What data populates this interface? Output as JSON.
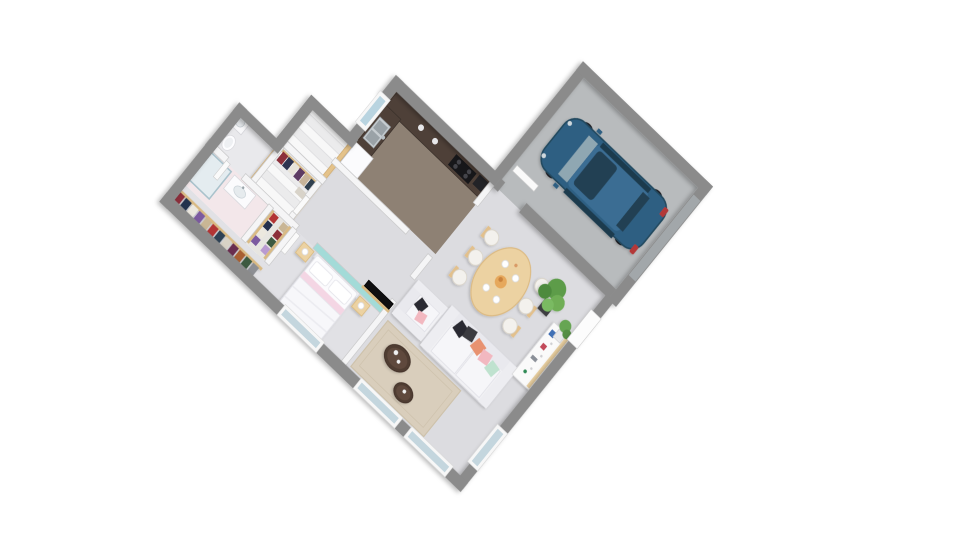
{
  "scene": {
    "description": "3D isometric top-down render of a single-storey house floor plan with attached garage",
    "view": "isometric",
    "background": "#ffffff"
  },
  "palette": {
    "exterior_wall": "#8b8b8b",
    "interior_wall": "#f5f5f6",
    "living_floor": "#dcdce0",
    "kitchen_floor": "#8e8174",
    "garage_floor": "#b8bbbd",
    "bathroom_floor": "#f3e7ea",
    "accent_teal_wall": "#a3dbd8",
    "wood_light": "#ecd2a2",
    "wood_rail": "#e4c28a",
    "countertop_dark": "#4e4038",
    "car_blue": "#2e5f82",
    "rug_beige": "#d9cebc",
    "pillow_coral": "#e8926f",
    "pillow_pink": "#f2b8c0",
    "pillow_mint": "#bfe2cf",
    "pillow_black": "#2c2c30"
  },
  "rooms": [
    {
      "name": "garage",
      "furniture": [
        "blue minivan car",
        "service door to house"
      ]
    },
    {
      "name": "kitchen",
      "furniture": [
        "L-shaped counter",
        "sink",
        "cooktop",
        "oven",
        "coffee machine",
        "fridge",
        "window above counter"
      ]
    },
    {
      "name": "dining-area",
      "furniture": [
        "oval wood table",
        "6 chairs",
        "plates",
        "bread basket"
      ]
    },
    {
      "name": "living-room",
      "furniture": [
        "white sofa with pillows",
        "armchair",
        "beige rug",
        "2 round coffee tables",
        "TV panel",
        "sideboard",
        "2 green plants",
        "2 south windows",
        "east window",
        "front door"
      ]
    },
    {
      "name": "staircase",
      "furniture": [
        "white steps",
        "wood balustrade",
        "black newel cap"
      ]
    },
    {
      "name": "wc-laundry",
      "furniture": [
        "washing machine",
        "toilet"
      ]
    },
    {
      "name": "walk-in-closet",
      "furniture": [
        "clothes rail with hanging clothes"
      ]
    },
    {
      "name": "dressing-corridor",
      "furniture": [
        "clothes rails both sides"
      ]
    },
    {
      "name": "bathroom",
      "furniture": [
        "glass shower",
        "vanity with basin"
      ]
    },
    {
      "name": "master-bedroom",
      "furniture": [
        "double bed with white duvet and pink throw",
        "2 wood nightstands with lamps",
        "teal accent wall",
        "wardrobe row with clothes",
        "south window"
      ]
    }
  ],
  "car": {
    "type": "minivan",
    "color": "#2e5f82",
    "location": "garage"
  }
}
